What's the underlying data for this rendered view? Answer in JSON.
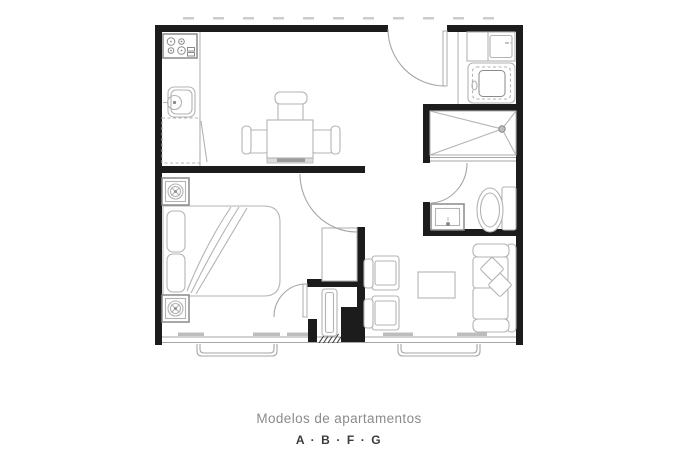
{
  "caption": {
    "title": "Modelos de apartamentos",
    "models": "A · B · F · G"
  },
  "colors": {
    "background": "#ffffff",
    "wall": "#1c1c1c",
    "furniture_line": "#b3b3b3",
    "furniture_dark": "#8a8a8a",
    "window_line": "#a6a6a6",
    "sill_fill": "#bdbdbd",
    "bench_fill": "#9a9a9a",
    "hatch_line": "#3f3f3f",
    "caption_title_color": "#8b8b8b",
    "caption_models_color": "#3b3b3b"
  },
  "floor_plan": {
    "type": "apartment-floor-plan",
    "rooms": [
      "kitchen",
      "dining-area",
      "bedroom",
      "bathroom",
      "laundry-closet",
      "living-area",
      "entry-vestibule"
    ],
    "fixtures": [
      "stove",
      "kitchen-sink",
      "kitchen-counter",
      "dining-table-with-chairs",
      "double-bed",
      "nightstands-with-lamps",
      "wardrobe",
      "shower",
      "toilet",
      "vanity-sink",
      "washer-unit",
      "sofa-with-pillows",
      "armchairs",
      "coffee-table",
      "entry-door",
      "windows-with-sills"
    ]
  }
}
